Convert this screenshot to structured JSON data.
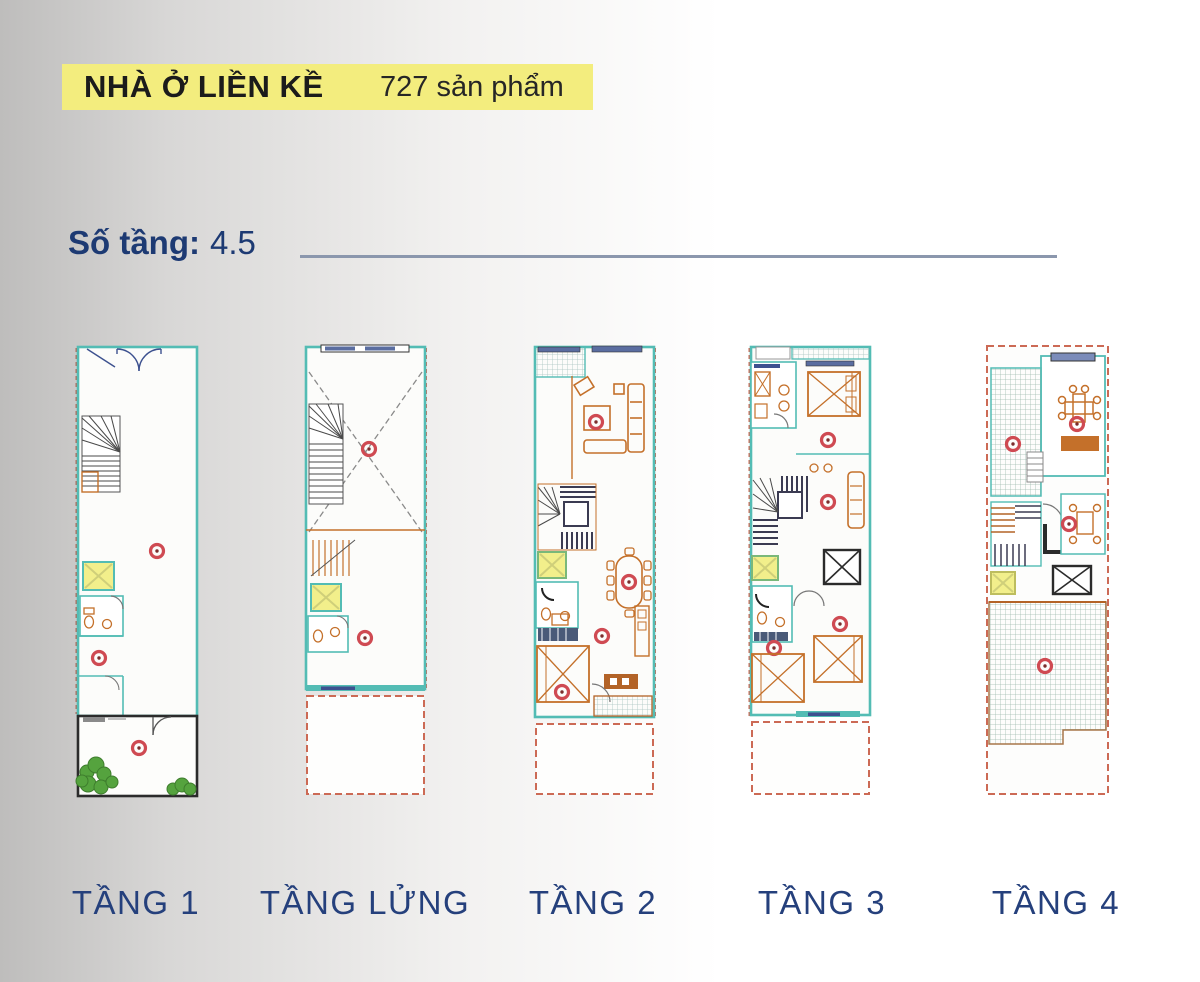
{
  "header": {
    "title": "NHÀ Ở LIỀN KỀ",
    "product_count": "727 sản phẩm",
    "highlight_color": "#f3ed7e"
  },
  "spec": {
    "label": "Số tầng:",
    "value": "4.5"
  },
  "floor_plans": [
    {
      "id": "tang-1",
      "label": "TẦNG 1"
    },
    {
      "id": "tang-lung",
      "label": "TẦNG LỬNG"
    },
    {
      "id": "tang-2",
      "label": "TẦNG 2"
    },
    {
      "id": "tang-3",
      "label": "TẦNG 3"
    },
    {
      "id": "tang-4",
      "label": "TẦNG 4"
    }
  ],
  "colors": {
    "accent_navy": "#25407c",
    "highlight_yellow": "#f3ed7e",
    "plan_wall_teal": "#53bcb4",
    "plan_furniture_orange": "#c4702a",
    "plan_marker_red": "#cf4a52",
    "plan_boundary_dashed": "#cc6a55",
    "divider_line": "#8b97ad",
    "garden_green": "#55a33e"
  }
}
